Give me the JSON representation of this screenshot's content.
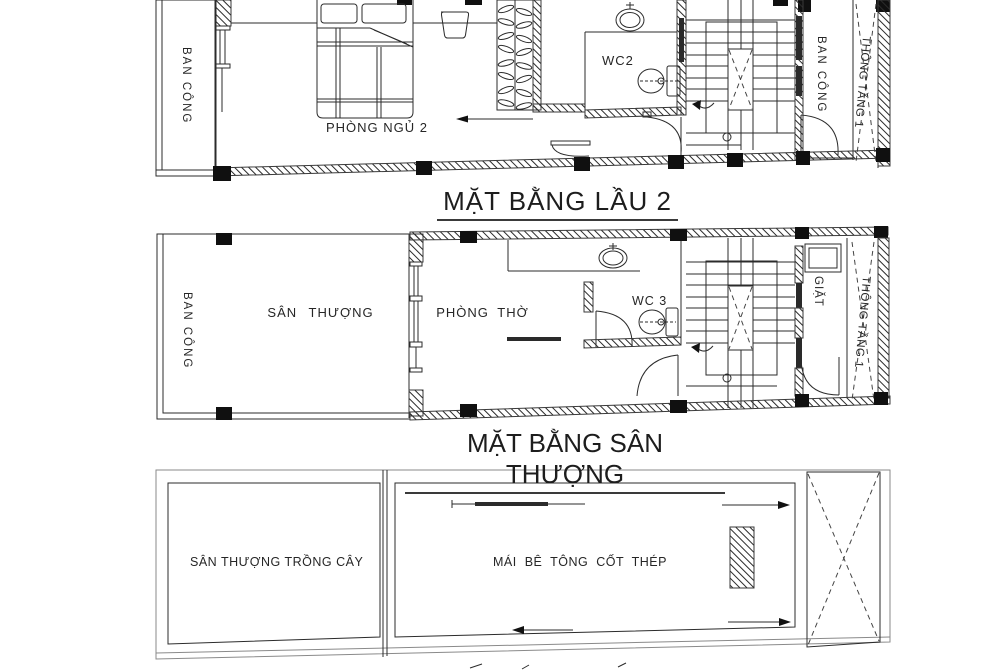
{
  "sheet": {
    "plan_floor2": {
      "title": "MẶT BẰNG LẦU 2",
      "labels": {
        "balcony_left": "BAN CÔNG",
        "bedroom": "PHÒNG NGỦ 2",
        "wc": "WC2",
        "balcony_right": "BAN CÔNG",
        "void_shaft": "THÔNG TẦNG 1"
      }
    },
    "plan_terrace": {
      "title": "MẶT BẰNG SÂN THƯỢNG",
      "labels": {
        "balcony_left": "BAN CÔNG",
        "terrace": "SÂN THƯỢNG",
        "worship_room": "PHÒNG THỜ",
        "wc": "WC 3",
        "laundry": "GIẶT",
        "void_shaft": "THÔNG TẦNG 1"
      }
    },
    "plan_roof": {
      "labels": {
        "planted_terrace": "SÂN THƯỢNG TRỒNG CÂY",
        "concrete_roof": "MÁI BÊ TÔNG CỐT THÉP"
      }
    },
    "colors": {
      "line": "#2b2b2b",
      "paper": "#ffffff"
    }
  }
}
